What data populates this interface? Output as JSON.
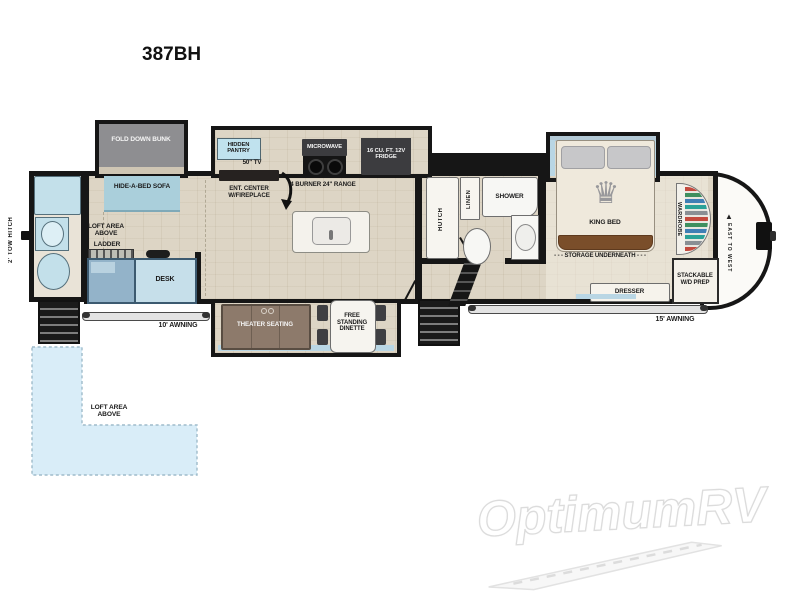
{
  "title": "387BH",
  "watermark": {
    "brand": "OptimumRV"
  },
  "exterior": {
    "tow_hitch": "2' TOW HITCH",
    "awning_front": "10' AWNING",
    "awning_rear": "15' AWNING",
    "brand_vertical": "EAST TO WEST"
  },
  "labels": {
    "fold_down_bunk": "FOLD DOWN BUNK",
    "hide_a_bed_sofa": "HIDE-A-BED SOFA",
    "loft_area_above_front": "LOFT AREA ABOVE",
    "ladder": "LADDER",
    "desk": "DESK",
    "hidden_pantry": "HIDDEN PANTRY",
    "tv_50": "50\" TV",
    "ent_center": "ENT. CENTER W/FIREPLACE",
    "microwave": "MICROWAVE",
    "range": "4 BURNER 24\" RANGE",
    "fridge": "16 CU. FT. 12V FRIDGE",
    "theater_seating": "THEATER SEATING",
    "free_standing_dinette": "FREE STANDING DINETTE",
    "hutch": "HUTCH",
    "linen": "LINEN",
    "shower": "SHOWER",
    "king_bed": "KING BED",
    "storage_underneath": "- - - STORAGE UNDERNEATH - - -",
    "dresser": "DRESSER",
    "wardrobe": "WARDROBE",
    "stackable_wd_prep": "STACKABLE W/D PREP",
    "loft_area_above_bottom": "LOFT AREA ABOVE"
  },
  "icons": {
    "crown": "♛",
    "mountain": "▲"
  },
  "colors": {
    "wall": "#161616",
    "floor": "#ddd5c5",
    "window": "#b9d6e4",
    "fixture_blue": "#c3e0ea",
    "sofa_blue": "#aacfdb",
    "bunk_gray": "#8e8e91",
    "appliance_dark": "#3c3c3f",
    "theater_brown": "#8d7a6b",
    "bed_cream": "#efe9dc",
    "bed_foot_brown": "#7a4e2a",
    "loft_blue": "#d9edf8",
    "desk_blue": "#c6dfea",
    "chair_blue": "#93b3c9"
  }
}
